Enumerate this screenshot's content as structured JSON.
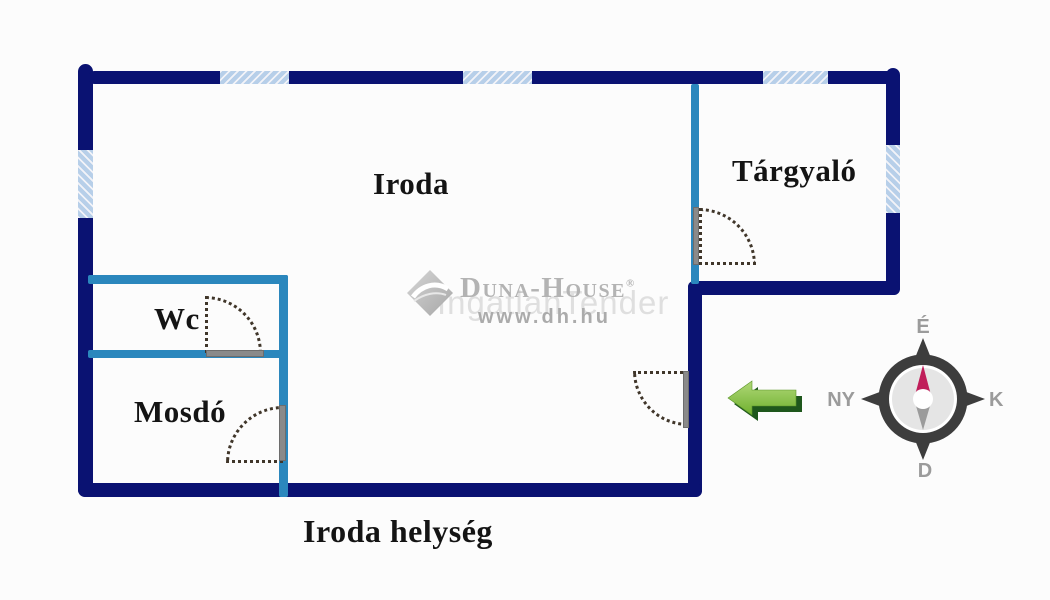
{
  "floorplan": {
    "caption": "Iroda helység",
    "rooms": [
      {
        "name": "Iroda"
      },
      {
        "name": "Tárgyaló"
      },
      {
        "name": "Wc"
      },
      {
        "name": "Mosdó"
      }
    ]
  },
  "watermark": {
    "brand": "Duna-House",
    "registered_mark": "®",
    "website": "www.dh.hu",
    "overlay_text": "IngatlanTender"
  },
  "compass": {
    "north_label": "É",
    "east_label": "K",
    "south_label": "D",
    "west_label": "NY"
  },
  "colors": {
    "outer_wall": "#0a1272",
    "partition_wall": "#2b87bd",
    "window_fill": "#b7cfe9",
    "door_leaf": "#8a8a8a",
    "door_swing_dots": "#40362a",
    "arrow_light_green": "#8cc63f",
    "arrow_dark_green": "#1e571c",
    "compass_frame": "#3d3d3d",
    "compass_needle_north": "#c01e5a",
    "compass_needle_south": "#9b9b9b",
    "watermark_gray": "#b3b3b3"
  }
}
